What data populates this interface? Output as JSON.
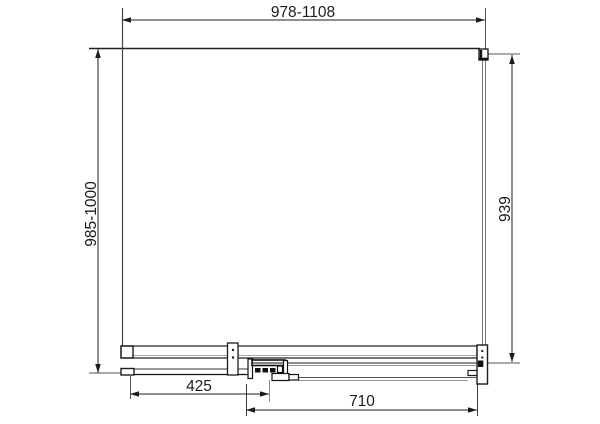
{
  "drawing": {
    "labels": {
      "overall_width": "978-1108",
      "overall_height": "985-1000",
      "glass_height": "939",
      "left_segment_width": "425",
      "door_width": "710"
    },
    "colors": {
      "background": "#ffffff",
      "line_dark": "#1c1c1c",
      "line_medium": "#555555",
      "line_light": "#999999"
    }
  }
}
